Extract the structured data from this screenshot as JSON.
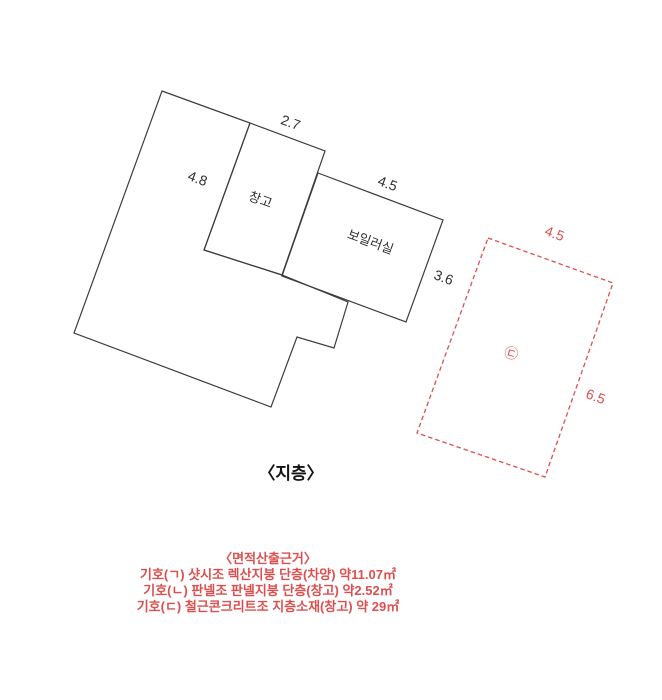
{
  "colors": {
    "line": "#3c3c3c",
    "ink": "#2f2f2f",
    "red": "#dc4f4f"
  },
  "plan": {
    "floor_caption": "〈지층〉",
    "rooms": {
      "storage": "창고",
      "boiler": "보일러실"
    },
    "dims": {
      "main_left": "4.8",
      "storage_top": "2.7",
      "boiler_top": "4.5",
      "boiler_right": "3.6",
      "annex_top": "4.5",
      "annex_right": "6.5"
    },
    "annex_symbol": "㉢"
  },
  "notes": {
    "title": "〈면적산출근거〉",
    "lines": [
      "기호(ㄱ) 샷시조 렉산지붕 단층(차양) 약11.07㎡",
      "기호(ㄴ) 판넬조 판넬지붕 단층(창고) 약2.52㎡",
      "기호(ㄷ) 철근콘크리트조 지층소재(창고) 약 29㎡"
    ]
  }
}
